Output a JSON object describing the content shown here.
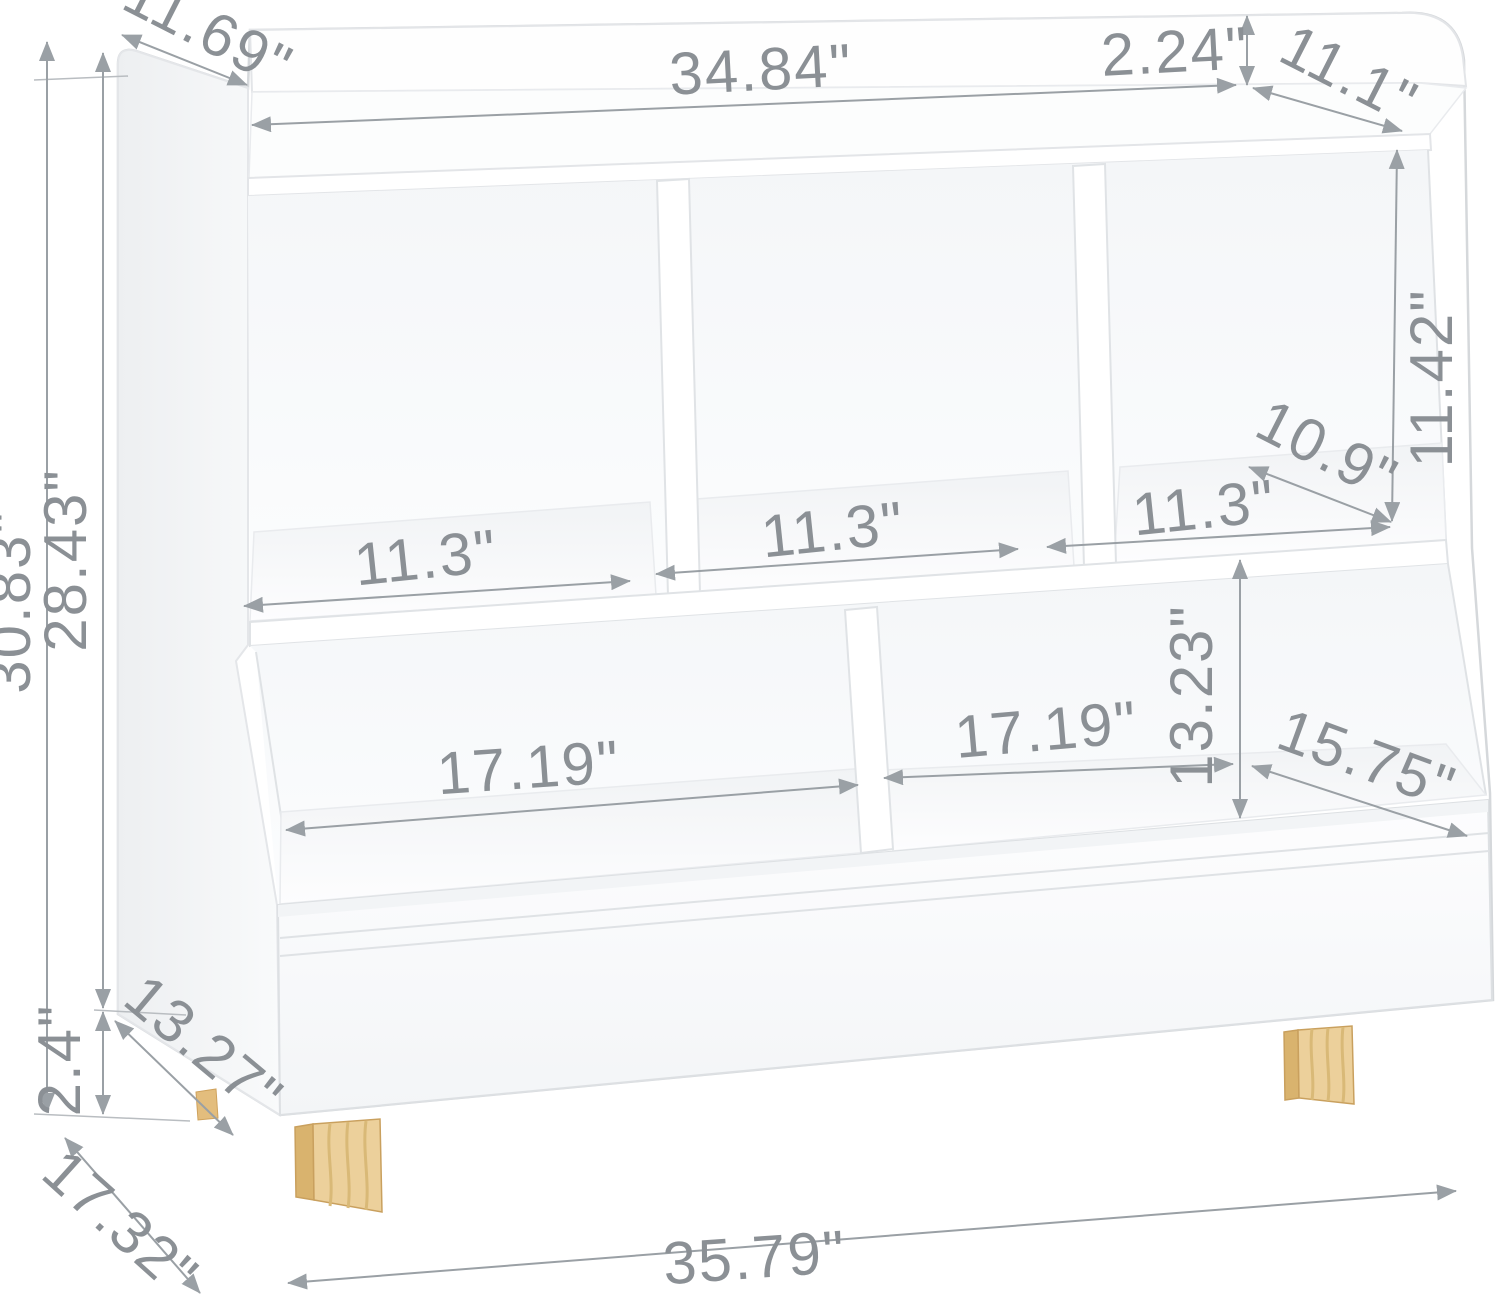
{
  "diagram": {
    "type": "product-dimension-diagram",
    "product": "5-cubby kids toy storage organizer with bins and wood legs",
    "background_color": "#ffffff",
    "dimension_text_color": "#8b9095",
    "dimension_line_color": "#9aa0a5",
    "furniture_color": "#ffffff",
    "wood_leg_color": "#ecd09b",
    "dimensions": {
      "top_shelf_depth_left": "11.69\"",
      "top_shelf_width": "34.84\"",
      "back_rail_height": "2.24\"",
      "top_shelf_depth_right": "11.1\"",
      "cubby_height": "11.42\"",
      "cubby_depth": "10.9\"",
      "cubby_width_left": "11.3\"",
      "cubby_width_middle": "11.3\"",
      "cubby_width_right": "11.3\"",
      "overall_height": "30.83\"",
      "body_height": "28.43\"",
      "leg_height": "2.4\"",
      "bin_height": "13.23\"",
      "bin_width_left": "17.19\"",
      "bin_width_right": "17.19\"",
      "bin_depth_right": "15.75\"",
      "bin_depth_left": "13.27\"",
      "base_depth": "17.32\"",
      "overall_width": "35.79\""
    }
  }
}
